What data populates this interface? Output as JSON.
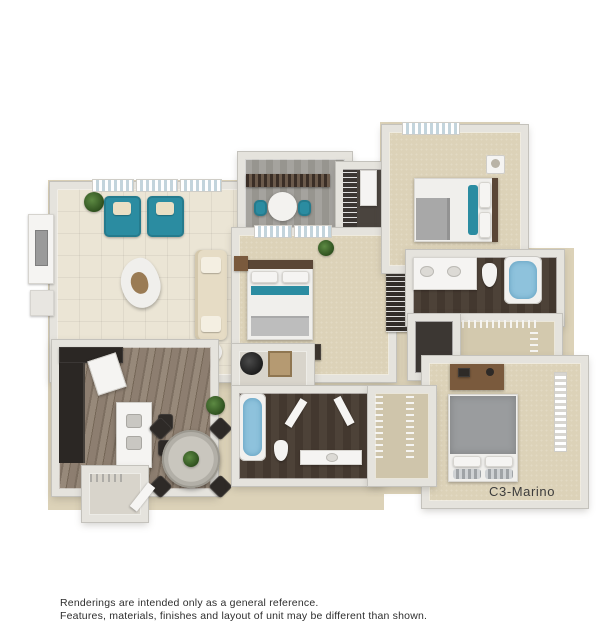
{
  "plan": {
    "name": "C3-Marino",
    "kind": "3D apartment floor plan rendering",
    "accent_color": "#2b8ca1",
    "wall_color": "#e5e3dd",
    "carpet_color": "#dcd2b8",
    "water_color": "#8ec2dc"
  },
  "disclaimer": {
    "line1": "Renderings are intended only as a general reference.",
    "line2": "Features, materials, finishes and layout of unit may be different than shown."
  },
  "rooms": {
    "living_room": [
      "three windows",
      "two teal armchairs with cream pillows",
      "cream sofa",
      "organic coffee table",
      "tv console on left wall",
      "potted plant",
      "floor lamp table"
    ],
    "balcony": [
      "dark wood railing",
      "round bistro table",
      "two teal chairs",
      "gray plank decking"
    ],
    "master_bedroom": [
      "two windows",
      "bed with teal accent runner",
      "wood headboard",
      "nightstand with lamp",
      "plant",
      "dresser with framed art"
    ],
    "bedroom_2": [
      "window",
      "bed with teal pillows and gray throw",
      "nightstand with lamp"
    ],
    "bedroom_3": [
      "side window with blinds",
      "gray duvet bed with striped pillows",
      "wood desk"
    ],
    "bathroom_1": [
      "double sink vanity",
      "toilet",
      "soaking tub with water"
    ],
    "bathroom_2": [
      "tub with water",
      "toilet",
      "vanity with sink",
      "dark plank floor"
    ],
    "closets": [
      "walk-in closet wire shelving x2",
      "linen shelves",
      "pantry closet",
      "utility closet with water heater"
    ],
    "kitchen": [
      "dark cabinets",
      "refrigerator",
      "island with double sink",
      "two bar stools",
      "plank flooring"
    ],
    "dining": [
      "round glass table with centerpiece",
      "four dark chairs",
      "plant"
    ]
  }
}
